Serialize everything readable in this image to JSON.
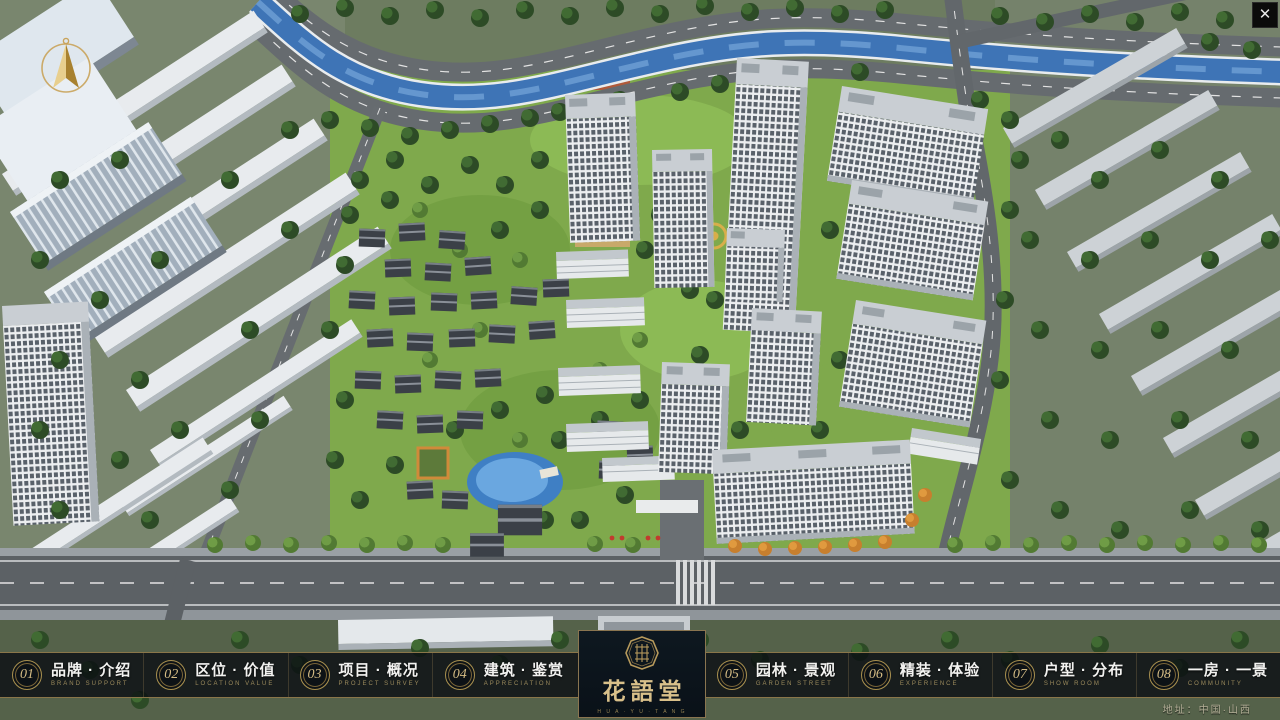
{
  "close_button": {
    "glyph": "✕"
  },
  "nav": {
    "items": [
      {
        "num": "01",
        "cn": "品牌 · 介绍",
        "en": "BRAND SUPPORT"
      },
      {
        "num": "02",
        "cn": "区位 · 价值",
        "en": "LOCATION VALUE"
      },
      {
        "num": "03",
        "cn": "项目 · 概况",
        "en": "PROJECT SURVEY"
      },
      {
        "num": "04",
        "cn": "建筑 · 鉴赏",
        "en": "APPRECIATION"
      },
      {
        "num": "05",
        "cn": "园林 · 景观",
        "en": "GARDEN STREET"
      },
      {
        "num": "06",
        "cn": "精装 · 体验",
        "en": "EXPERIENCE"
      },
      {
        "num": "07",
        "cn": "户型 · 分布",
        "en": "SHOW ROOM"
      },
      {
        "num": "08",
        "cn": "一房 · 一景",
        "en": "COMMUNITY"
      }
    ]
  },
  "logo": {
    "name_cn": "花語堂",
    "subtext": "H U A · Y U · T A N G"
  },
  "footer": {
    "address": "地址：中国·山西"
  },
  "colors": {
    "accent_gold": "#c9a959",
    "bar_background": "rgba(9,13,17,0.80)",
    "river_blue": "#3e74b6",
    "grass_green": "#7fa94c",
    "tree_green": "#2d4b26",
    "road_grey": "#5c6165"
  }
}
